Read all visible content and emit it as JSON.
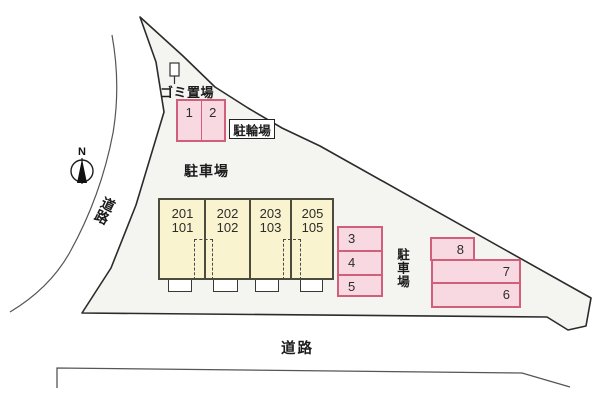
{
  "title": "site-plan",
  "labels": {
    "garbage_area": "ゴミ置場",
    "bicycle_parking": "駐輪場",
    "parking_main": "駐車場",
    "parking_right": "駐車場",
    "road_left": "道路",
    "road_bottom": "道路",
    "compass_north": "N"
  },
  "building": {
    "units": [
      {
        "upper": "201",
        "lower": "101"
      },
      {
        "upper": "202",
        "lower": "102"
      },
      {
        "upper": "203",
        "lower": "103"
      },
      {
        "upper": "205",
        "lower": "105"
      }
    ]
  },
  "parking_spaces": {
    "bike_row": [
      "1",
      "2"
    ],
    "middle_column": [
      "3",
      "4",
      "5"
    ],
    "right_group": [
      "8",
      "7",
      "6"
    ]
  },
  "colors": {
    "site-fill": "#f4f4f1",
    "site-outline": "#2b2b2b",
    "building-fill": "#f9f3d0",
    "building-border": "#4b4b3e",
    "space-fill": "#f9d9e1",
    "space-border": "#cf5f7a",
    "road-line": "#555555"
  }
}
